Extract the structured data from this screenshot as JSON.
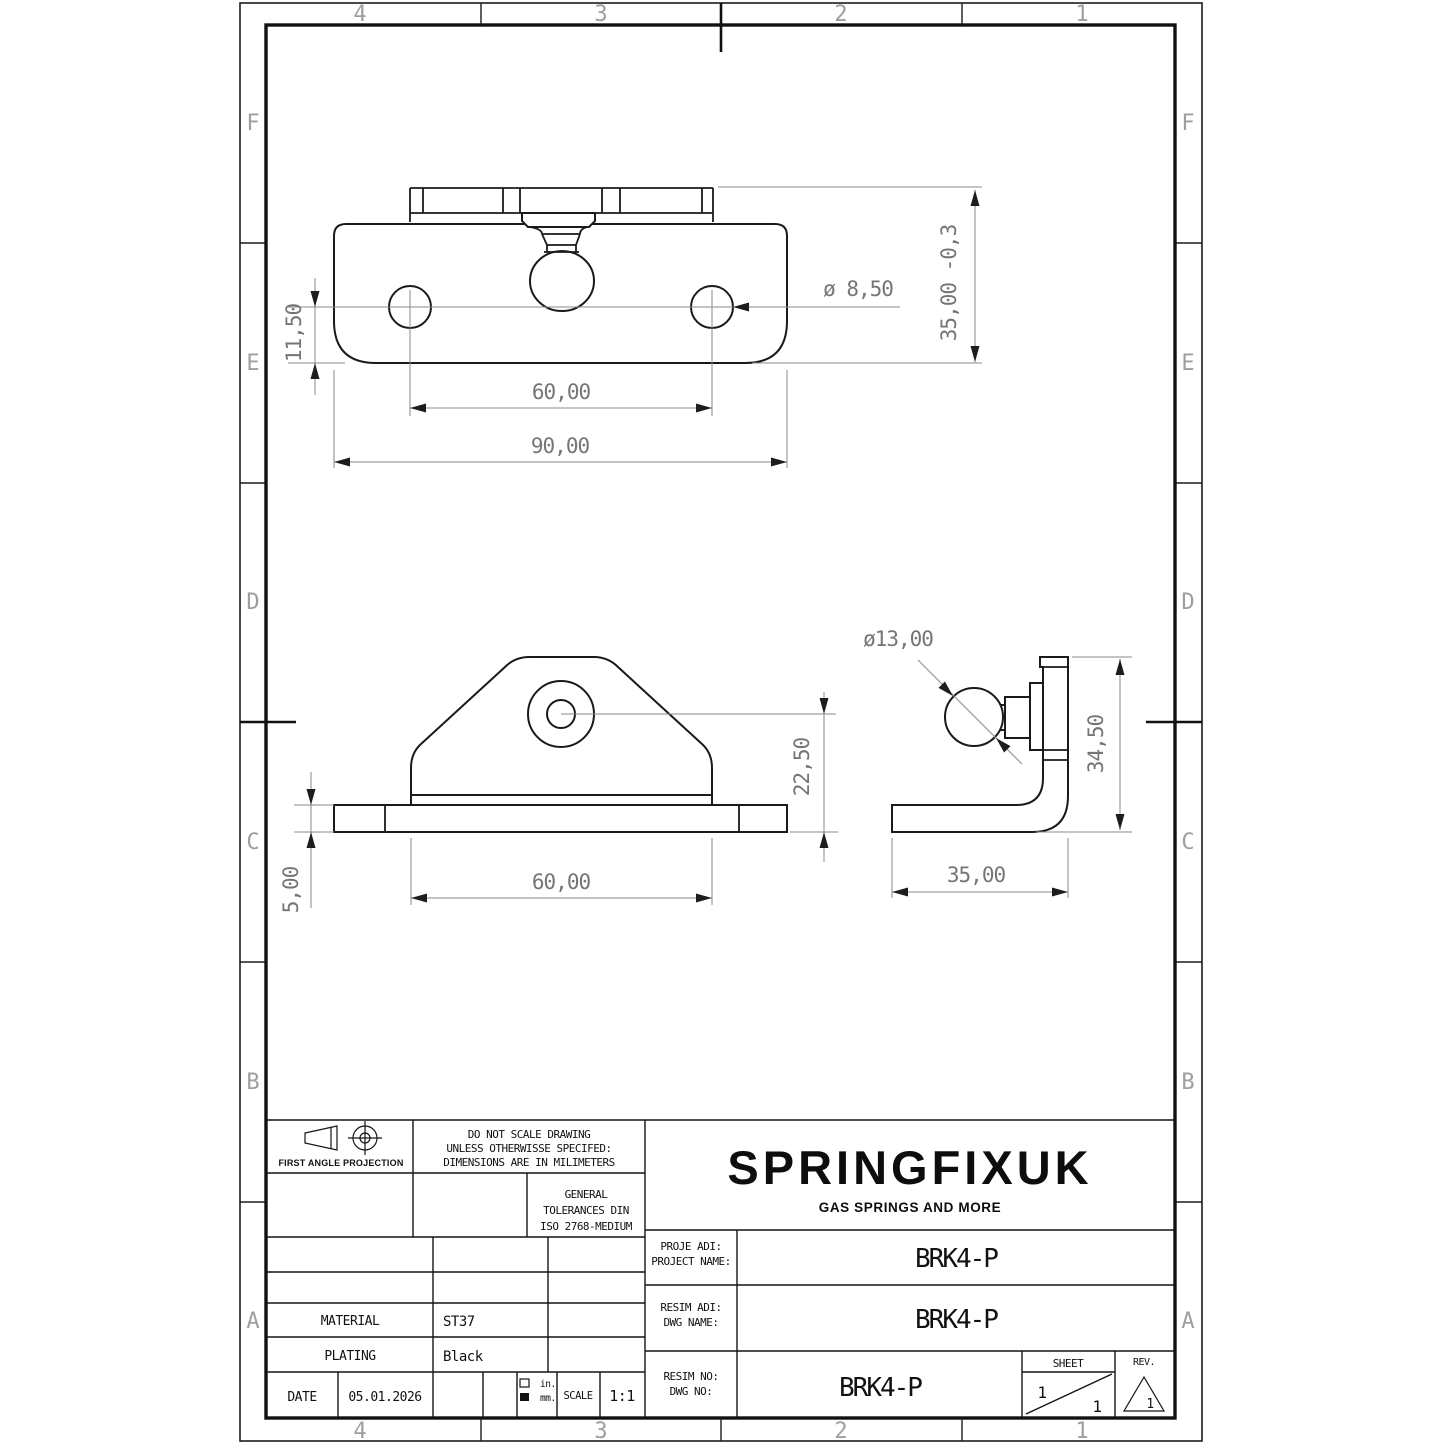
{
  "colors": {
    "outline": "#1a1a1a",
    "construction": "#8a8a8a",
    "dimension_text": "#757575",
    "zone_label": "#9e9e9e",
    "background": "#ffffff"
  },
  "sheet": {
    "cols": [
      "4",
      "3",
      "2",
      "1"
    ],
    "rows": [
      "F",
      "E",
      "D",
      "C",
      "B",
      "A"
    ]
  },
  "views": {
    "top": {
      "offset": "11,50",
      "spacing": "60,00",
      "width": "90,00",
      "hole_dia": "ø 8,50",
      "plate_width": "35,00 -0,3"
    },
    "front": {
      "thickness": "5,00",
      "width": "60,00",
      "hole_height": "22,50"
    },
    "side": {
      "ball_dia": "ø13,00",
      "height": "34,50",
      "depth": "35,00"
    }
  },
  "title_block": {
    "projection_label": "FIRST ANGLE PROJECTION",
    "note_line1": "DO NOT SCALE DRAWING",
    "note_line2": "UNLESS OTHERWISSE SPECIFED:",
    "note_line3": "DIMENSIONS ARE IN MILIMETERS",
    "tolerance_line1": "GENERAL",
    "tolerance_line2": "TOLERANCES DIN",
    "tolerance_line3": "ISO 2768-MEDIUM",
    "company": "SPRINGFIXUK",
    "tagline": "GAS SPRINGS AND MORE",
    "project_label_tr": "PROJE ADI:",
    "project_label_en": "PROJECT NAME:",
    "project_name": "BRK4-P",
    "dwgname_label_tr": "RESIM ADI:",
    "dwgname_label_en": "DWG NAME:",
    "dwg_name": "BRK4-P",
    "dwgno_label_tr": "RESIM NO:",
    "dwgno_label_en": "DWG NO:",
    "dwg_no": "BRK4-P",
    "material_label": "MATERIAL",
    "material_value": "ST37",
    "plating_label": "PLATING",
    "plating_value": "Black",
    "date_label": "DATE",
    "date_value": "05.01.2026",
    "units_in": "in.",
    "units_mm": "mm.",
    "scale_label": "SCALE",
    "scale_value": "1:1",
    "sheet_label": "SHEET",
    "sheet_current": "1",
    "sheet_total": "1",
    "rev_label": "REV.",
    "rev_value": "1"
  }
}
